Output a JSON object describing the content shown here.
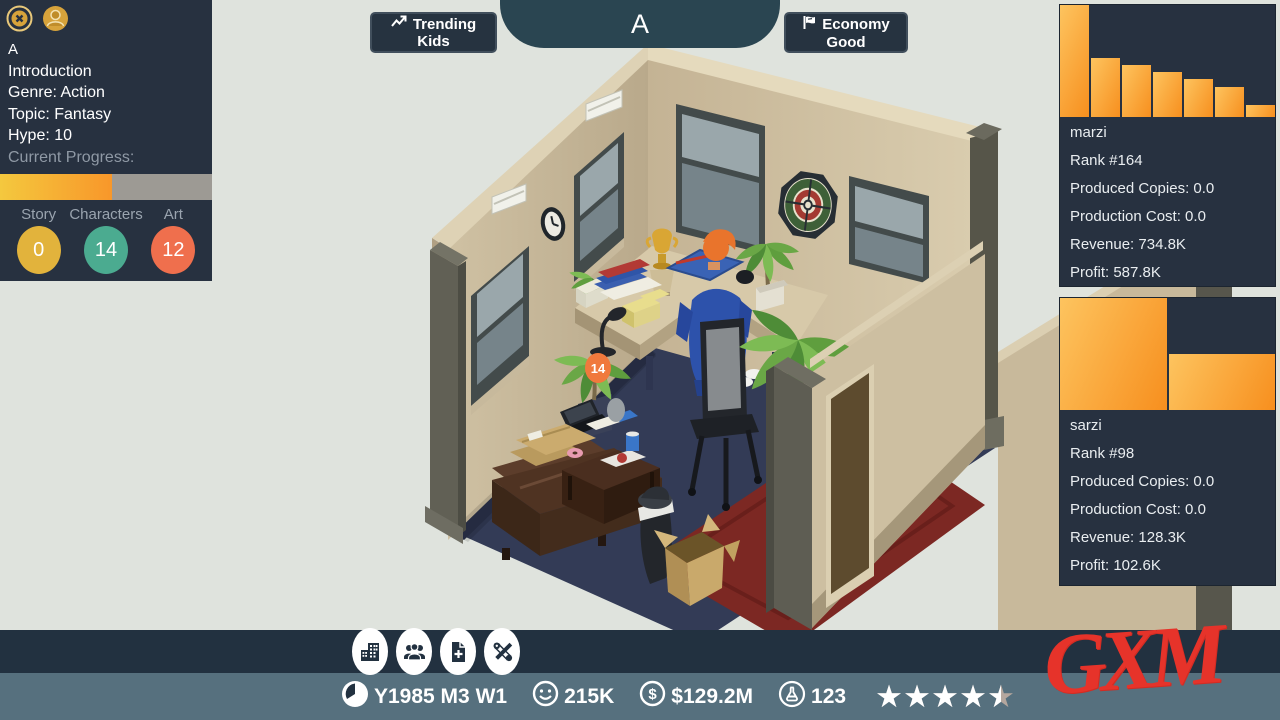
{
  "hud": {
    "project_panel": {
      "title": "A",
      "stage": "Introduction",
      "genre": "Genre: Action",
      "topic": "Topic: Fantasy",
      "hype": "Hype: 10",
      "progress_label": "Current Progress:",
      "progress_percent": 53,
      "stats": [
        {
          "label": "Story",
          "value": "0",
          "color": "#e2b33c"
        },
        {
          "label": "Characters",
          "value": "14",
          "color": "#4bab90"
        },
        {
          "label": "Art",
          "value": "12",
          "color": "#ef6f4d"
        }
      ]
    },
    "top_bar": {
      "trending_line1": "Trending",
      "trending_line2": "Kids",
      "studio_name": "A",
      "economy_line1": "Economy",
      "economy_line2": "Good"
    },
    "sales_panels": [
      {
        "name": "marzi",
        "rank": "Rank #164",
        "produced": "Produced Copies: 0.0",
        "cost": "Production Cost: 0.0",
        "revenue": "Revenue: 734.8K",
        "profit": "Profit: 587.8K"
      },
      {
        "name": "sarzi",
        "rank": "Rank #98",
        "produced": "Produced Copies: 0.0",
        "cost": "Production Cost: 0.0",
        "revenue": "Revenue: 128.3K",
        "profit": "Profit: 102.6K"
      }
    ],
    "toolbar_buttons": [
      "buildings",
      "staff",
      "new-project",
      "settings"
    ],
    "status_bar": {
      "date": "Y1985 M3 W1",
      "fans": "215K",
      "money": "$129.2M",
      "research": "123",
      "rating": 4.5
    },
    "watermark": "GXM",
    "scene_badge": "14"
  },
  "theme": {
    "panel_bg": "#273140",
    "status_bar_bg": "#56707e",
    "bottom_bar_bg": "#223140",
    "chart_bar_orange": "#f89b26",
    "watermark_red": "#e6332a",
    "pill_teal": "#2a4551"
  },
  "chart_data": [
    {
      "type": "bar",
      "title": "marzi sales history",
      "categories": [
        "w1",
        "w2",
        "w3",
        "w4",
        "w5",
        "w6",
        "w7"
      ],
      "values_pct_of_max": [
        100,
        53,
        46,
        40,
        34,
        27,
        11
      ],
      "bar_color": "#f89b26",
      "axis": "hidden",
      "grid": false,
      "legend": "none"
    },
    {
      "type": "bar",
      "title": "sarzi sales history",
      "categories": [
        "w1",
        "w2"
      ],
      "values_pct_of_max": [
        100,
        50
      ],
      "bar_color": "#f89b26",
      "axis": "hidden",
      "grid": false,
      "legend": "none"
    }
  ]
}
